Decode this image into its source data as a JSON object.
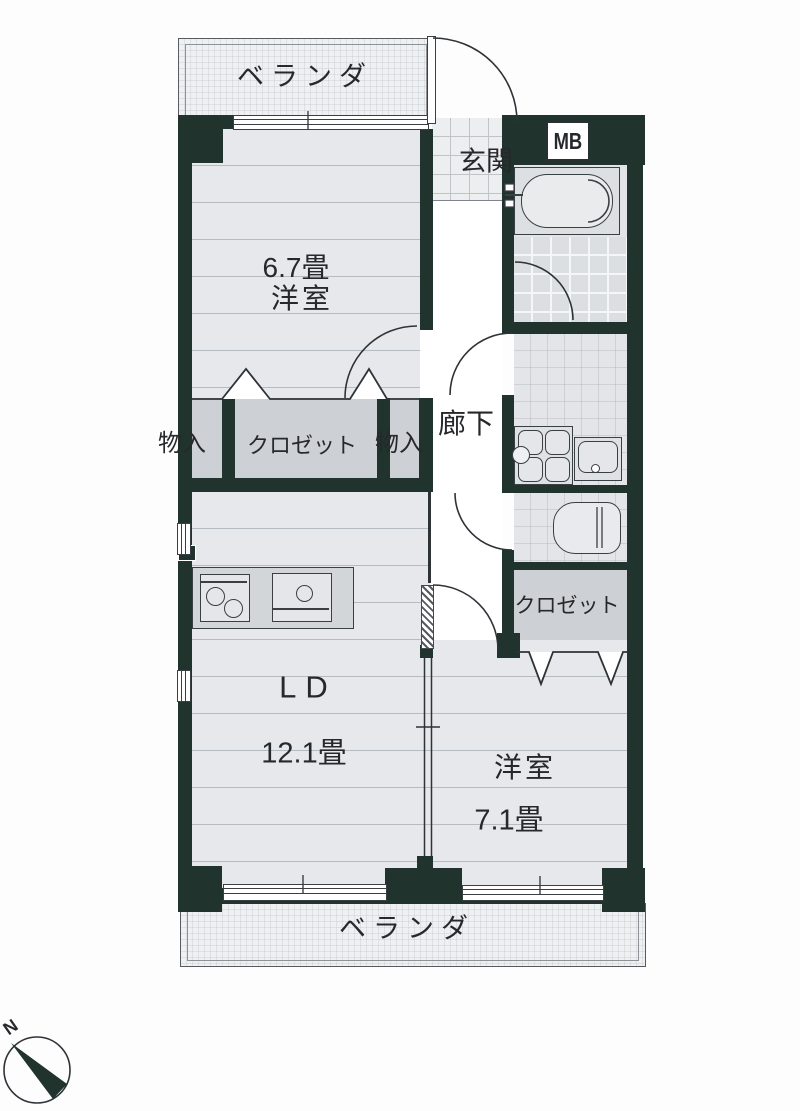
{
  "document": {
    "type": "apartment-floor-plan"
  },
  "colors": {
    "wall": "#20332c",
    "line": "#2e3338",
    "text": "#26282b",
    "floor": "#e6e8eb",
    "closet": "#cdd0d4",
    "tile": "#eceef0"
  },
  "labels": {
    "veranda_top": "ベランダ",
    "veranda_bottom": "ベランダ",
    "genkan": "玄関",
    "meter_box": "MB",
    "room1_size": "6.7畳",
    "room1_type": "洋室",
    "hallway": "廊下",
    "storage_left": "物入",
    "closet_main": "クロゼット",
    "storage_right": "物入",
    "closet_right": "クロゼット",
    "living_label": "LD",
    "living_size": "12.1畳",
    "room2_type": "洋室",
    "room2_size": "7.1畳",
    "compass_north": "N"
  },
  "rooms": [
    {
      "name": "洋室",
      "size": "6.7畳"
    },
    {
      "name": "LD",
      "size": "12.1畳"
    },
    {
      "name": "洋室",
      "size": "7.1畳"
    }
  ]
}
